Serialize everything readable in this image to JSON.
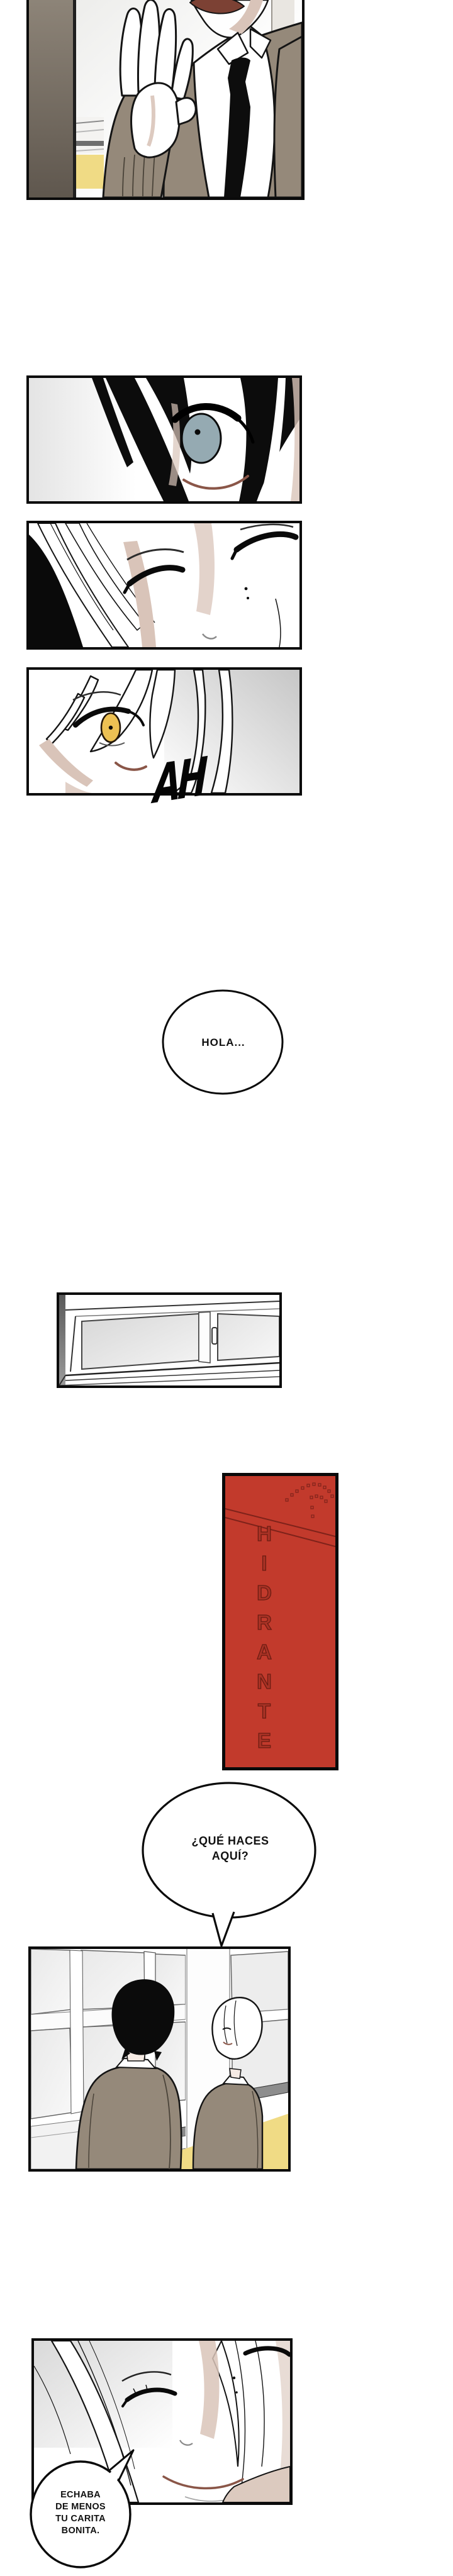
{
  "page": {
    "background": "#ffffff",
    "type": "webtoon-strip"
  },
  "speech_bubbles": {
    "hola": {
      "text": "HOLA..."
    },
    "que_haces": {
      "line1": "¿QUÉ HACES",
      "line2": "AQUÍ?"
    },
    "echaba": {
      "line1": "ECHABA",
      "line2": "DE MENOS",
      "line3": "TU CARITA",
      "line4": "BONITA."
    }
  },
  "sfx": {
    "ah": "AH"
  },
  "signs": {
    "hydrant": "HIDRANTE"
  },
  "colors": {
    "red": "#c23a2c",
    "red_dark": "#6b1c12",
    "red_letter": "#a93225",
    "taupe": "#95897a",
    "yellow": "#f0db85",
    "iris_blue": "#95aab2",
    "iris_gold": "#edc153",
    "mouth": "#7c4134",
    "mouth_line": "#8a5648",
    "skin_shadow": "#d9c4b9",
    "wall": "#6b6157",
    "sill": "#8d8d8d",
    "line": "#0a0a0a"
  }
}
